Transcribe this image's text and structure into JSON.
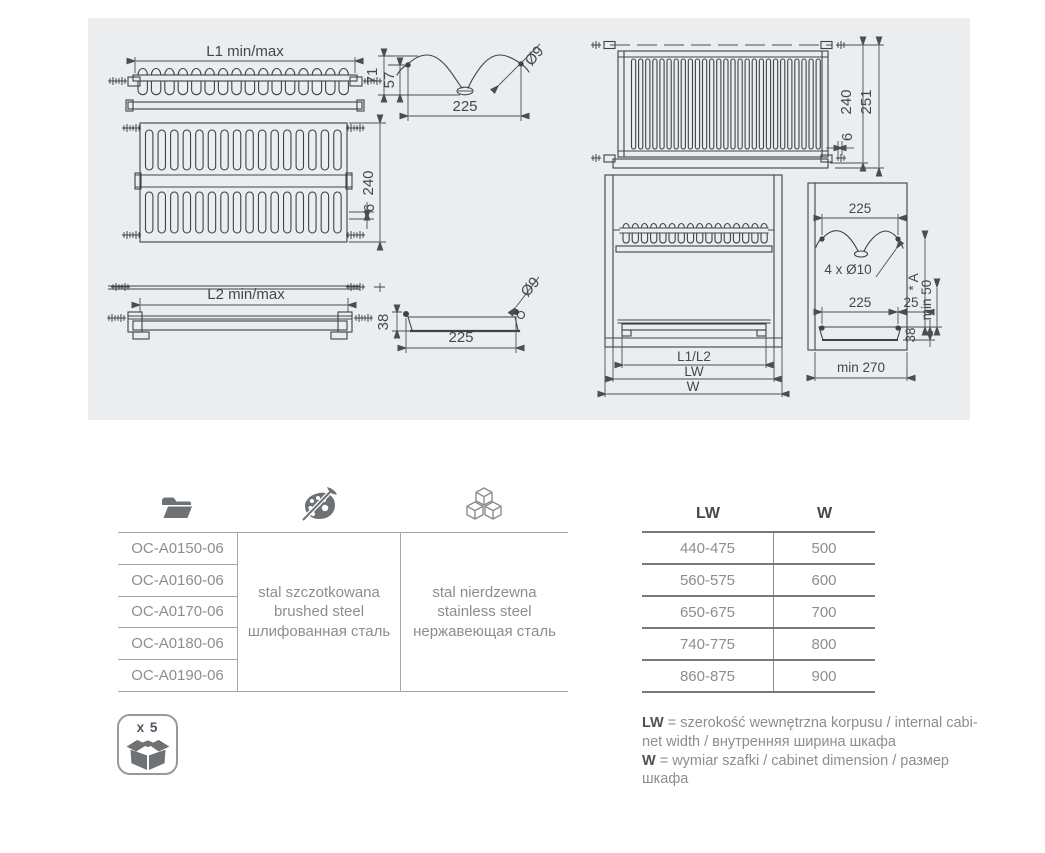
{
  "panel": {
    "rack_side": {
      "length": "L1 min/max"
    },
    "rack_top": {
      "depth": "240",
      "wire": "6"
    },
    "tray_side": {
      "length": "L2 min/max"
    },
    "hook_profile": {
      "height_outer": "71",
      "height_inner": "57",
      "width": "225",
      "hole": "Ø9"
    },
    "tray_profile": {
      "height": "38",
      "width": "225",
      "hole": "Ø9"
    },
    "rack_front": {
      "height_inner": "240",
      "height_outer": "251",
      "gap": "6"
    },
    "cabinet_front": {
      "rack_length": "L1/L2",
      "inner_width": "LW",
      "cabinet_width": "W"
    },
    "cabinet_side": {
      "hook_span": "225",
      "holes": "4 x Ø10",
      "tray_depth": "225",
      "front_gap": "25",
      "dim_a": "* A",
      "min_height": "min 50",
      "tray_height": "38",
      "min_depth": "min 270"
    }
  },
  "order_table": {
    "header_icons": [
      "folder-icon",
      "palette-icon",
      "cubes-icon"
    ],
    "codes": [
      "OC-A0150-06",
      "OC-A0160-06",
      "OC-A0170-06",
      "OC-A0180-06",
      "OC-A0190-06"
    ],
    "finish_brushed": "stal szczotkowana\nbrushed steel\nшлифованная сталь",
    "finish_stainless": "stal nierdzewna\nstainless steel\nнержавеющая сталь"
  },
  "size_table": {
    "col_lw": "LW",
    "col_w": "W",
    "rows": [
      [
        "440-475",
        "500"
      ],
      [
        "560-575",
        "600"
      ],
      [
        "650-675",
        "700"
      ],
      [
        "740-775",
        "800"
      ],
      [
        "860-875",
        "900"
      ]
    ]
  },
  "packaging": {
    "quantity": "x 5",
    "icon": "box-icon"
  },
  "legend": [
    {
      "term": "LW",
      "text": "= szerokość wewnętrzna korpusu / internal cabi-\nnet width / внутренняя ширина шкафа"
    },
    {
      "term": "W",
      "text": "= wymiar szafki / cabinet dimension / размер\nшкафа"
    }
  ],
  "colors": {
    "panel_bg": "#ecedee",
    "drawing_line": "#3f4347",
    "dim_text": "#44484c",
    "table_text": "#8b8e90",
    "table_border_light": "#a2a5a8",
    "table_border_dark": "#75797d",
    "header_text": "#464a4e",
    "icon_gray": "#6f7275"
  }
}
